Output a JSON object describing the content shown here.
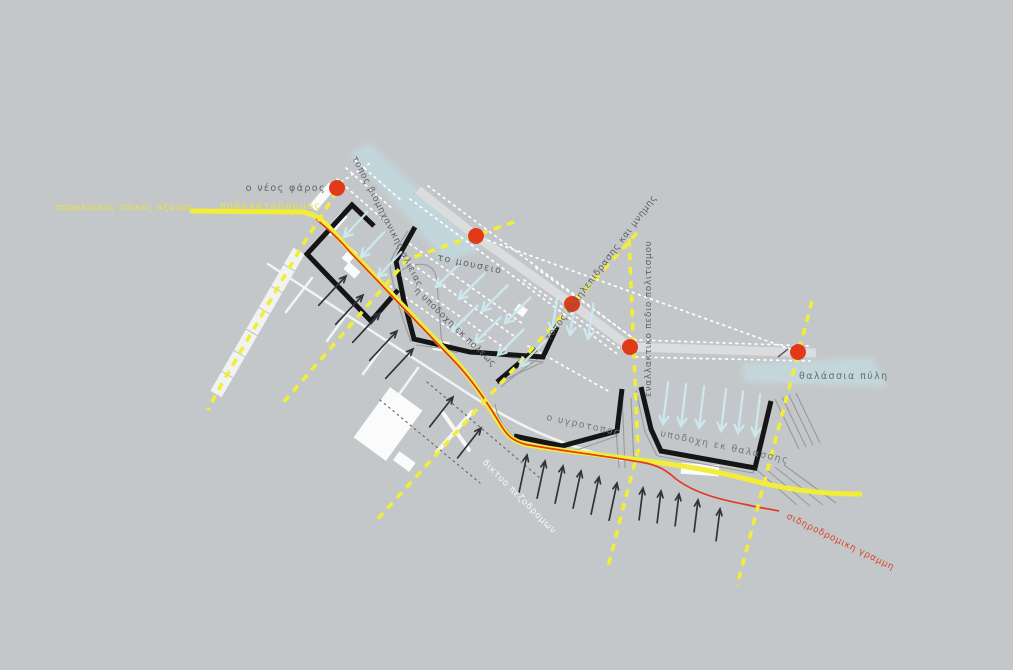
{
  "diagram": {
    "title": "harbor redevelopment concept plan",
    "background_color": "#c4c7c9",
    "colors": {
      "road_yellow": "#f2ee38",
      "railway_red": "#e2391f",
      "node_red": "#e23a19",
      "structure_black": "#151515",
      "label_gray": "#5e6366",
      "label_yellow": "#e9e43c",
      "label_white": "#f7f8f8",
      "label_red": "#d8452c",
      "flow_cyan": "#cceaef",
      "arrow_dark": "#303436",
      "road_white": "#dadcdd"
    },
    "labels": {
      "coastal_axis": {
        "text": "παραλιακος οδικος αξονας",
        "color": "#e9e43c"
      },
      "bike_path": {
        "text": "ποδηλατοδρομος",
        "color": "#e9e43c"
      },
      "new_lighthouse": {
        "text": "ο νέος φάρος",
        "color": "#5e6366"
      },
      "industrial_fishing": {
        "text": "τοπος βιομηχανικης αλιειας",
        "color": "#5e6366"
      },
      "museum": {
        "text": "το μουσειο",
        "color": "#5e6366"
      },
      "city_reception": {
        "text": "η υποδοχη εκ πολεως",
        "color": "#5e6366"
      },
      "interaction_memory": {
        "text": "τοπος αλληλεπιδρασης και μνημης",
        "color": "#5e6366"
      },
      "culture_field": {
        "text": "εναλλακτικο πεδιο πολιτισμου",
        "color": "#5e6366"
      },
      "sea_gate": {
        "text": "θαλάσσια πύλη",
        "color": "#686d70"
      },
      "wetland": {
        "text": "ο υγροτοπος",
        "color": "#75797b"
      },
      "sea_reception": {
        "text": "υποδοχη εκ θαλασσης",
        "color": "#75797b"
      },
      "pedestrian_network": {
        "text": "δικτυο πεζοδρομων",
        "color": "#f7f8f8"
      },
      "railway_line": {
        "text": "σιδηροδρομικη γραμμη",
        "color": "#d8452c"
      }
    },
    "nodes": {
      "count": 5,
      "color": "#e23a19"
    },
    "flows": {
      "sea_inflow_color": "#cceaef",
      "land_outflow_color": "#303436"
    }
  }
}
